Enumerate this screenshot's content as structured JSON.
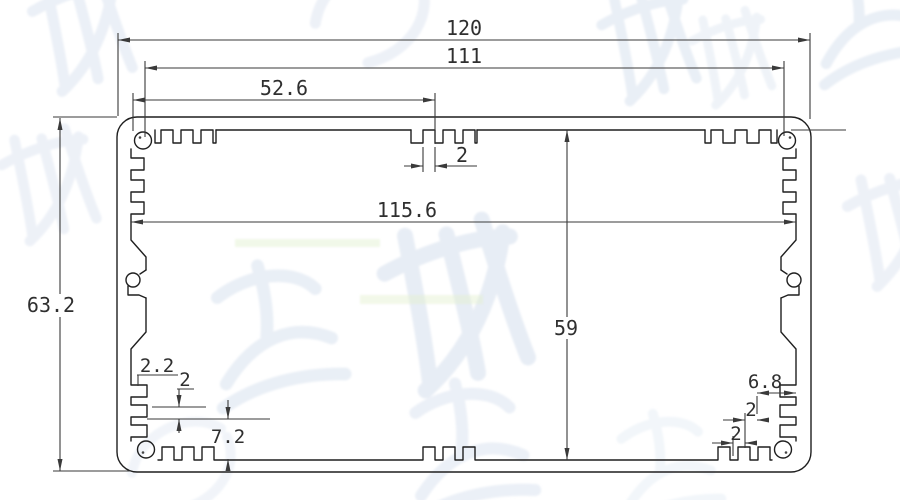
{
  "dims": {
    "overall_width": "120",
    "boss_span_width": "111",
    "left_segment_width": "52.6",
    "top_slot_tooth": "2",
    "inner_width": "115.6",
    "inner_height": "59",
    "overall_height": "63.2",
    "bl_tooth_width": "2.2",
    "bl_tooth_gap": "2",
    "bl_corner_height": "7.2",
    "br_corner_width": "6.8",
    "br_tooth_width": "2",
    "br_tooth_gap": "2"
  },
  "colors": {
    "background": "#ffffff",
    "profile_line": "#1f1f1f",
    "dimension_line": "#3a3a3a",
    "dimension_text": "#2f2f2f",
    "watermark": "#dbe4f0",
    "accent_streak": "#dff0cf"
  }
}
